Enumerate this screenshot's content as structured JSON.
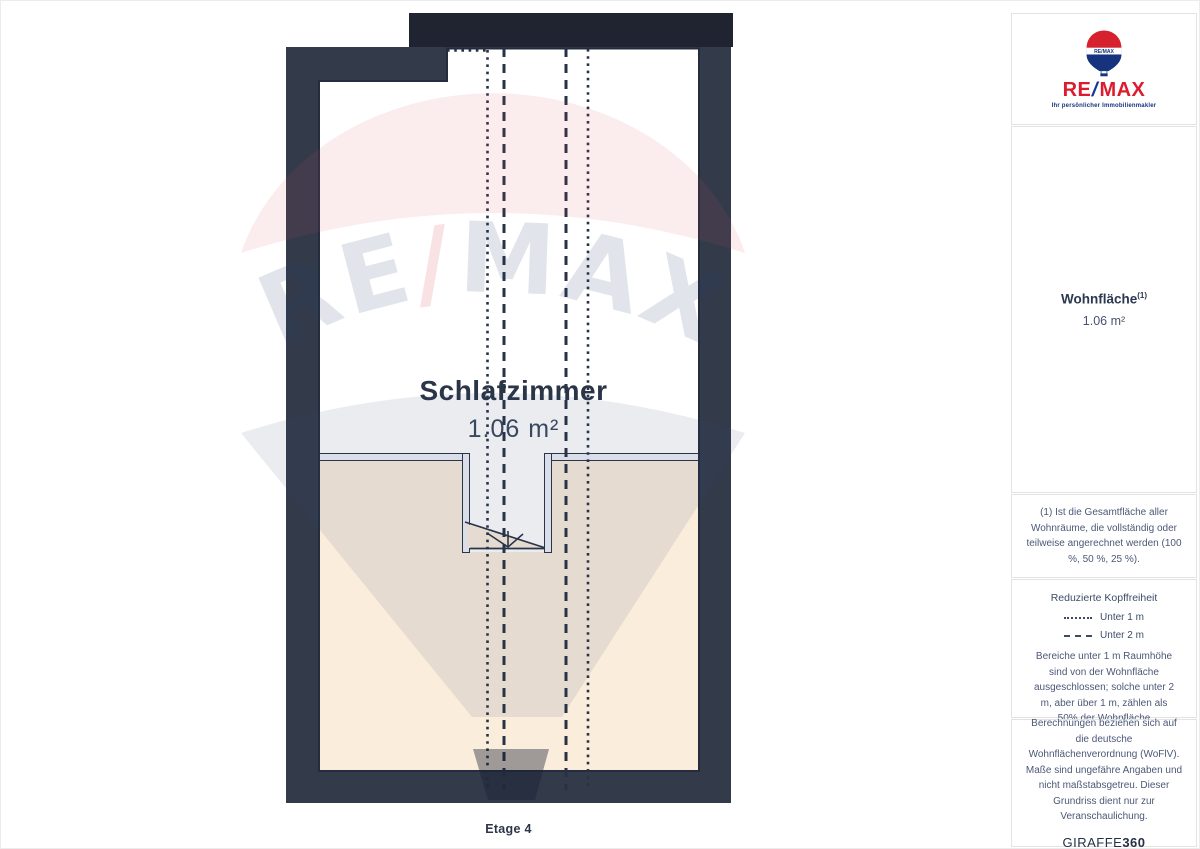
{
  "plan": {
    "room_label": "Schlafzimmer",
    "room_area": "1.06 m²",
    "floor_label": "Etage 4",
    "watermark": {
      "re": "RE",
      "slash": "/",
      "max": "MAX"
    }
  },
  "sidebar": {
    "logo": {
      "balloon_text": "RE/MAX",
      "re": "RE",
      "slash": "/",
      "max": "MAX",
      "tagline": "Ihr persönlicher Immobilienmakler"
    },
    "area_summary": {
      "title": "Wohnfläche",
      "superscript": "(1)",
      "value": "1.06 m²"
    },
    "footnote": {
      "text": "(1) Ist die Gesamtfläche aller Wohnräume, die vollständig oder teilweise angerechnet werden (100 %, 50 %, 25 %)."
    },
    "legend": {
      "title": "Reduzierte Kopffreiheit",
      "items": [
        {
          "style": "dotted",
          "label": "Unter 1 m"
        },
        {
          "style": "dashed",
          "label": "Unter 2 m"
        }
      ],
      "note": "Bereiche unter 1 m Raumhöhe sind von der Wohnfläche ausgeschlossen; solche unter 2 m, aber über 1 m, zählen als 50% der Wohnfläche"
    },
    "disclaimer": {
      "text": "Berechnungen beziehen sich auf die deutsche Wohnflächenverordnung (WoFlV). Maße sind ungefähre Angaben und nicht maßstabsgetreu. Dieser Grundriss dient nur zur Veranschaulichung."
    },
    "provider": {
      "name_regular": "GIRAFFE",
      "name_bold": "360"
    }
  },
  "colors": {
    "wall": "#333B4B",
    "upper_block": "#1F2430",
    "excluded_area": "#FBEDDC",
    "line": "#2A3447",
    "remax_red": "#DC1C2E",
    "remax_blue": "#15368C"
  }
}
